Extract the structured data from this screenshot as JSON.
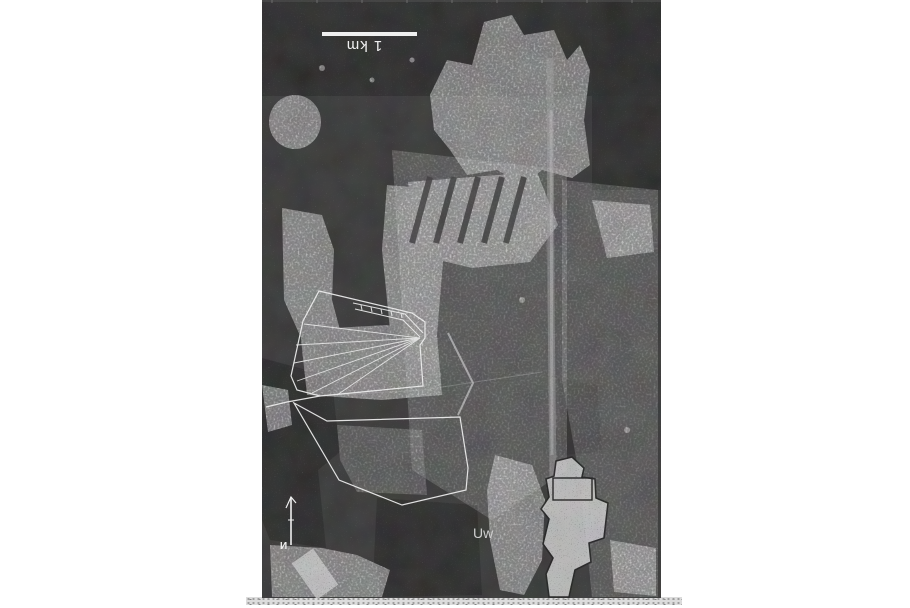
{
  "figure": {
    "scale_bar": {
      "label": "1 km"
    },
    "north_arrow": {
      "label": "И"
    },
    "annotation": {
      "label": "Uw"
    }
  },
  "colors": {
    "page_bg": "#ffffff",
    "photo_base": "#2b2b2b",
    "photo_dark": "#1c1c1c",
    "photo_mid": "#9f9f9f",
    "photo_light": "#c8c8c8",
    "overlay": "#efefef",
    "blob_outline": "#101010",
    "strip": "#d6d6d6"
  }
}
